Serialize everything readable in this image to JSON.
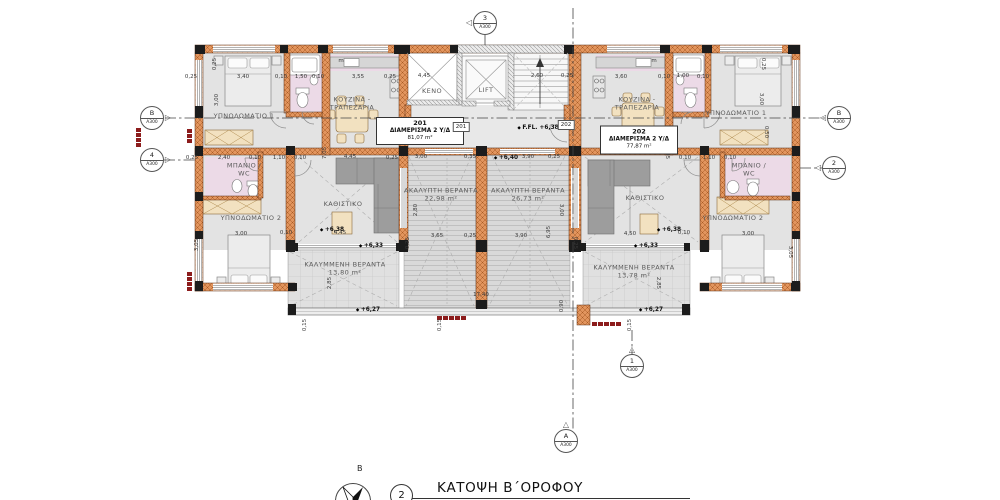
{
  "title": {
    "num": "2",
    "text": "ΚΑΤΟΨΗ Β΄ΟΡΟΦΟΥ",
    "north": "B"
  },
  "apartments": [
    {
      "tag": "201",
      "name": "ΔΙΑΜΕΡΙΣΜΑ 2 Υ/Δ",
      "area": "81,07 m²",
      "box": {
        "x": 377,
        "y": 118,
        "w": 86,
        "h": 26
      },
      "door_tag": "201",
      "door_x": 461,
      "door_y": 127
    },
    {
      "tag": "202",
      "name": "ΔΙΑΜΕΡΙΣΜΑ 2 Υ/Δ",
      "area": "77,87 m²",
      "box": {
        "x": 601,
        "y": 126,
        "w": 76,
        "h": 27
      },
      "door_tag": "202",
      "door_x": 566,
      "door_y": 125
    }
  ],
  "rooms": [
    {
      "t": "ΥΠΝΟΔΩΜΑΤΙΟ 1",
      "x": 244,
      "y": 116
    },
    {
      "t": "ΥΠΝΟΔΩΜΑΤΙΟ 1",
      "x": 736,
      "y": 113
    },
    {
      "t": "ΚΟΥΖΙΝΑ -\nΤΡΑΠΕΖΑΡΙΑ",
      "x": 352,
      "y": 104
    },
    {
      "t": "ΚΟΥΖΙΝΑ -\nΤΡΑΠΕΖΑΡΙΑ",
      "x": 637,
      "y": 104
    },
    {
      "t": "ΜΠΑΝΙΟ /\nWC",
      "x": 244,
      "y": 170
    },
    {
      "t": "ΜΠΑΝΙΟ /\nWC",
      "x": 749,
      "y": 170
    },
    {
      "t": "ΥΠΝΟΔΩΜΑΤΙΟ 2",
      "x": 251,
      "y": 218
    },
    {
      "t": "ΥΠΝΟΔΩΜΑΤΙΟ 2",
      "x": 733,
      "y": 218
    },
    {
      "t": "ΚΑΘΙΣΤΙΚΟ",
      "x": 343,
      "y": 204
    },
    {
      "t": "ΚΑΘΙΣΤΙΚΟ",
      "x": 645,
      "y": 198
    },
    {
      "t": "ΚΕΝΟ",
      "x": 432,
      "y": 91
    },
    {
      "t": "LIFT",
      "x": 486,
      "y": 90
    },
    {
      "t": "ΚΑΛΥΜΜΕΝΗ ΒΕΡΑΝΤΑ\n13,80 m²",
      "x": 345,
      "y": 269
    },
    {
      "t": "ΚΑΛΥΜΜΕΝΗ ΒΕΡΑΝΤΑ\n13,78 m²",
      "x": 634,
      "y": 272
    },
    {
      "t": "ΑΚΑΛΥΠΤΗ ΒΕΡΑΝΤΑ\n22,98 m²",
      "x": 441,
      "y": 195
    },
    {
      "t": "ΑΚΑΛΥΠΤΗ ΒΕΡΑΝΤΑ\n26,73 m²",
      "x": 528,
      "y": 195
    }
  ],
  "elevations": [
    {
      "t": "F.FL. +6,38",
      "x": 538,
      "y": 128
    },
    {
      "t": "+6,40",
      "x": 506,
      "y": 158
    },
    {
      "t": "+6,38",
      "x": 332,
      "y": 230
    },
    {
      "t": "+6,38",
      "x": 669,
      "y": 230
    },
    {
      "t": "+6,33",
      "x": 371,
      "y": 246
    },
    {
      "t": "+6,33",
      "x": 646,
      "y": 246
    },
    {
      "t": "+6,27",
      "x": 368,
      "y": 310
    },
    {
      "t": "+6,27",
      "x": 651,
      "y": 310
    }
  ],
  "dims": [
    {
      "t": "0,25",
      "x": 191,
      "y": 77
    },
    {
      "t": "3,40",
      "x": 243,
      "y": 77
    },
    {
      "t": "0,10",
      "x": 281,
      "y": 77
    },
    {
      "t": "1,50",
      "x": 301,
      "y": 77
    },
    {
      "t": "0,10",
      "x": 318,
      "y": 77
    },
    {
      "t": "3,55",
      "x": 358,
      "y": 77
    },
    {
      "t": "0,25",
      "x": 390,
      "y": 77
    },
    {
      "t": "4,45",
      "x": 424,
      "y": 76
    },
    {
      "t": "2,60",
      "x": 537,
      "y": 76
    },
    {
      "t": "0,25",
      "x": 567,
      "y": 76
    },
    {
      "t": "3,60",
      "x": 621,
      "y": 77
    },
    {
      "t": "0,10",
      "x": 664,
      "y": 77
    },
    {
      "t": "1,00",
      "x": 683,
      "y": 76
    },
    {
      "t": "0,10",
      "x": 703,
      "y": 77
    },
    {
      "t": "0,25",
      "x": 215,
      "y": 64,
      "r": -90
    },
    {
      "t": "3,00",
      "x": 217,
      "y": 100,
      "r": -90
    },
    {
      "t": "0,25",
      "x": 763,
      "y": 64,
      "r": 90
    },
    {
      "t": "3,00",
      "x": 761,
      "y": 99,
      "r": 90
    },
    {
      "t": "0,50",
      "x": 766,
      "y": 132,
      "r": 90
    },
    {
      "t": "0,25",
      "x": 192,
      "y": 158
    },
    {
      "t": "2,40",
      "x": 224,
      "y": 158
    },
    {
      "t": "0,10",
      "x": 255,
      "y": 158
    },
    {
      "t": "1,10",
      "x": 279,
      "y": 158
    },
    {
      "t": "0,10",
      "x": 300,
      "y": 158
    },
    {
      "t": "7,05",
      "x": 325,
      "y": 153,
      "r": -90
    },
    {
      "t": "4,45",
      "x": 350,
      "y": 157
    },
    {
      "t": "0,25",
      "x": 392,
      "y": 158
    },
    {
      "t": "3,00",
      "x": 421,
      "y": 157
    },
    {
      "t": "0,35",
      "x": 470,
      "y": 157
    },
    {
      "t": "3,90",
      "x": 528,
      "y": 157
    },
    {
      "t": "0,25",
      "x": 554,
      "y": 157
    },
    {
      "t": "0,10",
      "x": 685,
      "y": 158
    },
    {
      "t": "1,10",
      "x": 709,
      "y": 158
    },
    {
      "t": "0,10",
      "x": 730,
      "y": 158
    },
    {
      "t": "7,05",
      "x": 667,
      "y": 153,
      "r": 90
    },
    {
      "t": "3,00",
      "x": 241,
      "y": 234
    },
    {
      "t": "0,10",
      "x": 286,
      "y": 233
    },
    {
      "t": "4,45",
      "x": 340,
      "y": 233
    },
    {
      "t": "4,50",
      "x": 630,
      "y": 234
    },
    {
      "t": "0,10",
      "x": 684,
      "y": 233
    },
    {
      "t": "3,00",
      "x": 748,
      "y": 234
    },
    {
      "t": "3,05",
      "x": 197,
      "y": 245,
      "r": -90
    },
    {
      "t": "3,05",
      "x": 790,
      "y": 252,
      "r": 90
    },
    {
      "t": "2,80",
      "x": 416,
      "y": 210,
      "r": -90
    },
    {
      "t": "3,00",
      "x": 561,
      "y": 210,
      "r": 90
    },
    {
      "t": "6,95",
      "x": 549,
      "y": 232,
      "r": -90
    },
    {
      "t": "3,65",
      "x": 437,
      "y": 236
    },
    {
      "t": "0,25",
      "x": 470,
      "y": 236
    },
    {
      "t": "3,90",
      "x": 521,
      "y": 236
    },
    {
      "t": "17,40",
      "x": 481,
      "y": 295
    },
    {
      "t": "0,90",
      "x": 562,
      "y": 306,
      "r": -90
    },
    {
      "t": "0,15",
      "x": 305,
      "y": 325,
      "r": -90
    },
    {
      "t": "0,15",
      "x": 440,
      "y": 325,
      "r": -90
    },
    {
      "t": "0,15",
      "x": 630,
      "y": 325,
      "r": -90
    },
    {
      "t": "2,85",
      "x": 330,
      "y": 283,
      "r": -90
    },
    {
      "t": "2,85",
      "x": 658,
      "y": 283,
      "r": 90
    },
    {
      "t": "0,25",
      "x": 408,
      "y": 243,
      "r": -90
    },
    {
      "t": "0,25",
      "x": 575,
      "y": 243,
      "r": 90
    },
    {
      "t": "m",
      "x": 341,
      "y": 61
    },
    {
      "t": "m",
      "x": 654,
      "y": 61
    }
  ],
  "markers": [
    {
      "num": "3",
      "sheet": "Α300",
      "x": 485,
      "y": 23,
      "tri": "left"
    },
    {
      "num": "B",
      "sheet": "Α300",
      "x": 152,
      "y": 118,
      "tri": "right"
    },
    {
      "num": "B",
      "sheet": "Α300",
      "x": 839,
      "y": 118,
      "tri": "left"
    },
    {
      "num": "4",
      "sheet": "Α300",
      "x": 152,
      "y": 160,
      "tri": "right"
    },
    {
      "num": "2",
      "sheet": "Α300",
      "x": 834,
      "y": 168,
      "tri": "left"
    },
    {
      "num": "1",
      "sheet": "Α300",
      "x": 632,
      "y": 366,
      "tri": "up"
    },
    {
      "num": "A",
      "sheet": "Α300",
      "x": 566,
      "y": 441,
      "tri": "up"
    }
  ],
  "colors": {
    "wall_brick": "#e2955e",
    "wall_hatch": "#a85a24",
    "structure_dark": "#1c1c1c",
    "floor": "#e3e3e3",
    "bath_pink": "#ecdae7",
    "furniture_beige": "#f2e1c0",
    "sofa_gray": "#9d9d9d",
    "marker_red": "#8c1c1c"
  }
}
